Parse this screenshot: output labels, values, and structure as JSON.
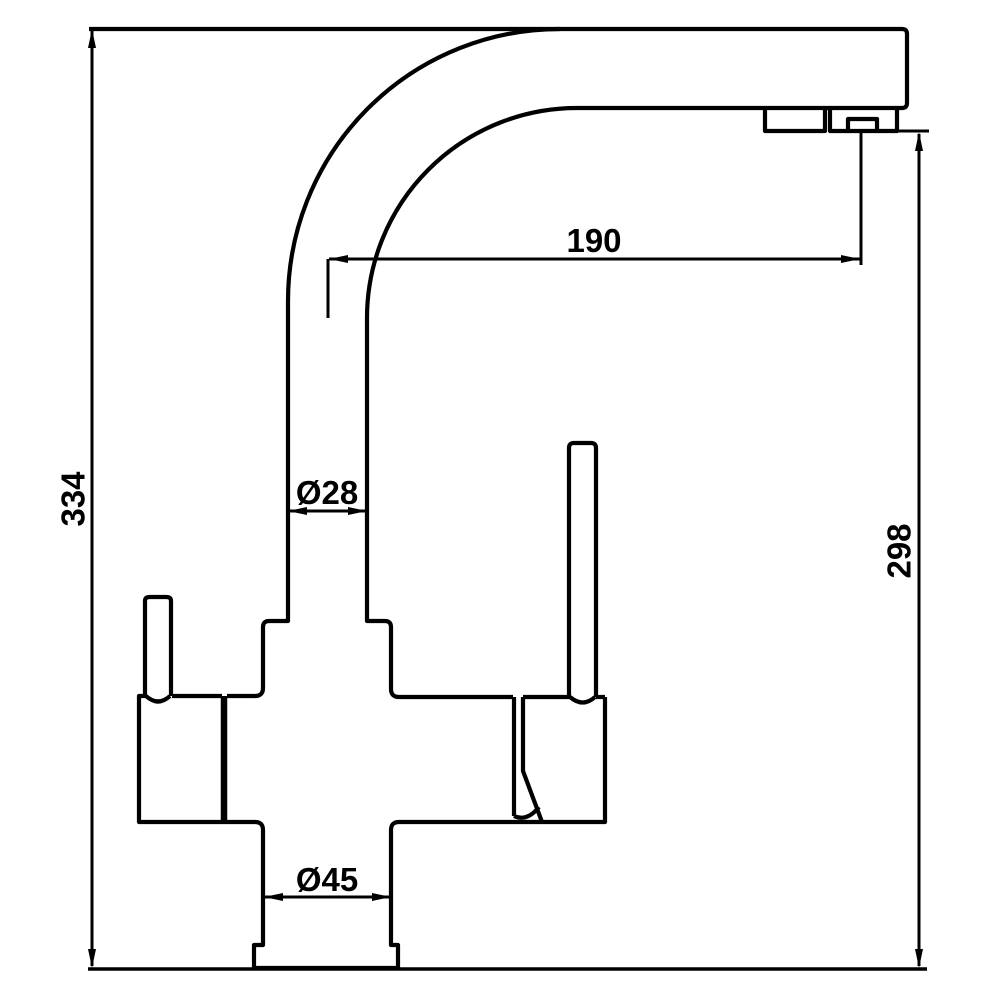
{
  "diagram": {
    "type": "technical-drawing",
    "subject": "kitchen mixer tap side elevation with dimensions",
    "colors": {
      "line": "#000000",
      "background": "#ffffff"
    },
    "dimensions": {
      "overall_height": "334",
      "spout_height": "298",
      "spout_reach": "190",
      "column_diameter": "Ø28",
      "base_diameter": "Ø45"
    }
  }
}
